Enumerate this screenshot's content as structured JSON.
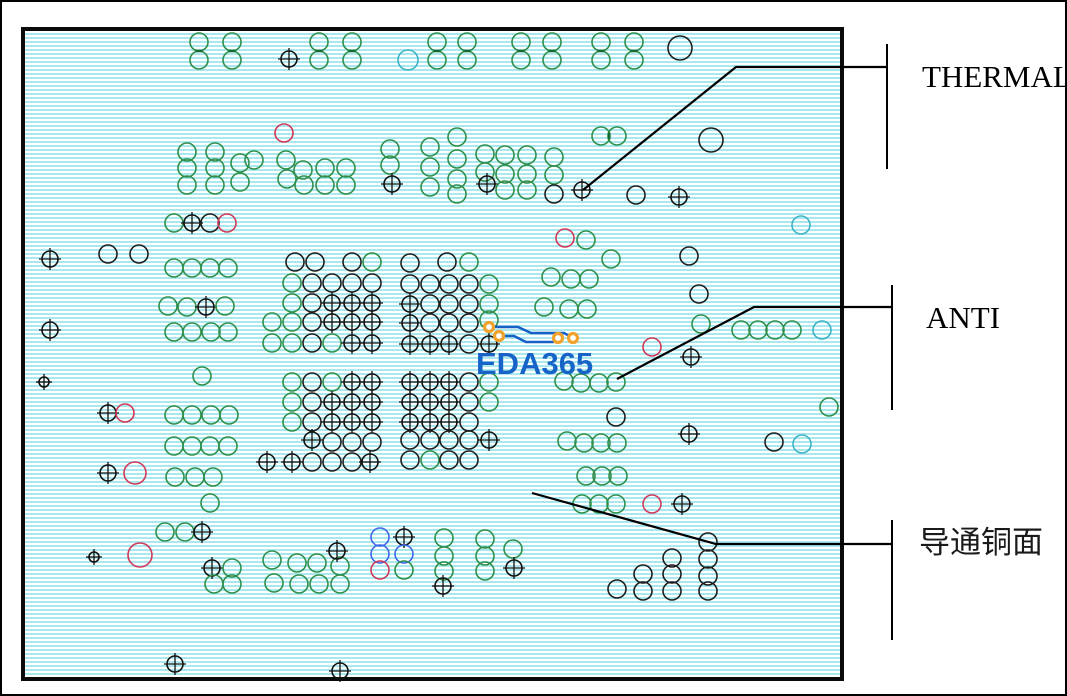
{
  "board": {
    "stripe_color": "#a9e9ed",
    "background": "#ffffff",
    "border_color": "#0a0a0a"
  },
  "watermark": {
    "text": "EDA365",
    "color": "#1764c8"
  },
  "palette": {
    "g": "#2f8f4c",
    "k": "#1f1f1f",
    "r": "#cf3a5a",
    "c": "#3fb3c6",
    "b": "#4169e8",
    "x": "#111111",
    "xs": "#111111",
    "trace": "#1660c6",
    "pad": "#f0a22c",
    "callout": "#000000",
    "dash": "#156b33"
  },
  "callouts": [
    {
      "id": "thermal",
      "label": "THERMAL",
      "points": [
        [
          581,
          188
        ],
        [
          734,
          65
        ],
        [
          885,
          65
        ]
      ],
      "bracket": [
        [
          885,
          42
        ],
        [
          885,
          167
        ]
      ]
    },
    {
      "id": "anti",
      "label": "ANTI",
      "points": [
        [
          615,
          377
        ],
        [
          752,
          305
        ],
        [
          890,
          305
        ]
      ],
      "bracket": [
        [
          890,
          283
        ],
        [
          890,
          408
        ]
      ]
    },
    {
      "id": "copper",
      "label": "导通铜面",
      "points": [
        [
          530,
          491
        ],
        [
          714,
          542
        ],
        [
          890,
          542
        ]
      ],
      "bracket": [
        [
          890,
          518
        ],
        [
          890,
          638
        ]
      ]
    }
  ],
  "traces": [
    [
      [
        487,
        325
      ],
      [
        516,
        325
      ],
      [
        529,
        331
      ],
      [
        562,
        331
      ],
      [
        571,
        336
      ]
    ],
    [
      [
        497,
        334
      ],
      [
        512,
        334
      ],
      [
        524,
        340
      ],
      [
        551,
        340
      ],
      [
        556,
        336
      ]
    ]
  ],
  "trace_pads": [
    [
      487,
      325
    ],
    [
      497,
      334
    ],
    [
      556,
      336
    ],
    [
      571,
      336
    ]
  ],
  "pair_dashes": [
    [
      197,
      49,
      "h"
    ],
    [
      230,
      49,
      "h"
    ],
    [
      317,
      49,
      "h"
    ],
    [
      350,
      49,
      "h"
    ],
    [
      435,
      49,
      "h"
    ],
    [
      465,
      49,
      "h"
    ],
    [
      519,
      49,
      "h"
    ],
    [
      550,
      49,
      "h"
    ],
    [
      599,
      49,
      "h"
    ],
    [
      632,
      49,
      "h"
    ],
    [
      607,
      134,
      "v"
    ]
  ],
  "vias": [
    [
      197,
      40,
      "g"
    ],
    [
      197,
      58,
      "g"
    ],
    [
      230,
      40,
      "g"
    ],
    [
      230,
      58,
      "g"
    ],
    [
      317,
      40,
      "g"
    ],
    [
      317,
      58,
      "g"
    ],
    [
      350,
      40,
      "g"
    ],
    [
      350,
      58,
      "g"
    ],
    [
      435,
      40,
      "g"
    ],
    [
      435,
      58,
      "g"
    ],
    [
      465,
      40,
      "g"
    ],
    [
      465,
      58,
      "g"
    ],
    [
      519,
      40,
      "g"
    ],
    [
      519,
      58,
      "g"
    ],
    [
      550,
      40,
      "g"
    ],
    [
      550,
      58,
      "g"
    ],
    [
      599,
      40,
      "g"
    ],
    [
      599,
      58,
      "g"
    ],
    [
      632,
      40,
      "g"
    ],
    [
      632,
      58,
      "g"
    ],
    [
      287,
      57,
      "x"
    ],
    [
      678,
      46,
      "k",
      12
    ],
    [
      406,
      58,
      "c",
      10
    ],
    [
      282,
      131,
      "r"
    ],
    [
      599,
      134,
      "g"
    ],
    [
      615,
      134,
      "g"
    ],
    [
      709,
      138,
      "k",
      12
    ],
    [
      185,
      150,
      "g"
    ],
    [
      185,
      166,
      "g"
    ],
    [
      185,
      183,
      "g"
    ],
    [
      213,
      150,
      "g"
    ],
    [
      213,
      166,
      "g"
    ],
    [
      213,
      183,
      "g"
    ],
    [
      238,
      161,
      "g"
    ],
    [
      238,
      180,
      "g"
    ],
    [
      252,
      158,
      "g"
    ],
    [
      284,
      158,
      "g"
    ],
    [
      301,
      168,
      "g"
    ],
    [
      285,
      177,
      "g"
    ],
    [
      302,
      183,
      "g"
    ],
    [
      323,
      166,
      "g"
    ],
    [
      323,
      183,
      "g"
    ],
    [
      344,
      166,
      "g"
    ],
    [
      344,
      183,
      "g"
    ],
    [
      388,
      147,
      "g"
    ],
    [
      388,
      163,
      "g"
    ],
    [
      390,
      182,
      "x"
    ],
    [
      428,
      145,
      "g"
    ],
    [
      428,
      165,
      "g"
    ],
    [
      428,
      185,
      "g"
    ],
    [
      455,
      135,
      "g"
    ],
    [
      455,
      157,
      "g"
    ],
    [
      455,
      177,
      "g"
    ],
    [
      455,
      192,
      "g"
    ],
    [
      483,
      152,
      "g"
    ],
    [
      483,
      170,
      "g"
    ],
    [
      485,
      182,
      "x"
    ],
    [
      503,
      153,
      "g"
    ],
    [
      503,
      172,
      "g"
    ],
    [
      503,
      188,
      "g"
    ],
    [
      525,
      153,
      "g"
    ],
    [
      525,
      172,
      "g"
    ],
    [
      525,
      188,
      "g"
    ],
    [
      552,
      155,
      "g"
    ],
    [
      552,
      173,
      "g"
    ],
    [
      552,
      192,
      "k"
    ],
    [
      580,
      188,
      "x"
    ],
    [
      634,
      193,
      "k"
    ],
    [
      677,
      195,
      "x"
    ],
    [
      48,
      257,
      "x"
    ],
    [
      106,
      252,
      "k"
    ],
    [
      137,
      252,
      "k"
    ],
    [
      172,
      266,
      "g"
    ],
    [
      190,
      266,
      "g"
    ],
    [
      208,
      266,
      "g"
    ],
    [
      226,
      266,
      "g"
    ],
    [
      48,
      328,
      "x"
    ],
    [
      166,
      304,
      "g"
    ],
    [
      185,
      305,
      "g"
    ],
    [
      204,
      305,
      "x"
    ],
    [
      223,
      304,
      "g"
    ],
    [
      172,
      330,
      "g"
    ],
    [
      190,
      330,
      "g"
    ],
    [
      209,
      330,
      "g"
    ],
    [
      226,
      330,
      "g"
    ],
    [
      200,
      374,
      "g"
    ],
    [
      42,
      380,
      "xs"
    ],
    [
      106,
      411,
      "x"
    ],
    [
      123,
      411,
      "r"
    ],
    [
      172,
      413,
      "g"
    ],
    [
      190,
      413,
      "g"
    ],
    [
      209,
      413,
      "g"
    ],
    [
      227,
      413,
      "g"
    ],
    [
      172,
      444,
      "g"
    ],
    [
      190,
      444,
      "g"
    ],
    [
      208,
      444,
      "g"
    ],
    [
      226,
      444,
      "g"
    ],
    [
      106,
      471,
      "x"
    ],
    [
      133,
      471,
      "r",
      11
    ],
    [
      173,
      475,
      "g"
    ],
    [
      193,
      475,
      "g"
    ],
    [
      211,
      475,
      "g"
    ],
    [
      208,
      501,
      "g"
    ],
    [
      163,
      530,
      "g"
    ],
    [
      183,
      530,
      "g"
    ],
    [
      200,
      530,
      "x"
    ],
    [
      92,
      555,
      "xs"
    ],
    [
      138,
      553,
      "r",
      12
    ],
    [
      210,
      566,
      "x"
    ],
    [
      230,
      566,
      "g"
    ],
    [
      212,
      582,
      "g"
    ],
    [
      230,
      582,
      "g"
    ],
    [
      172,
      221,
      "g"
    ],
    [
      190,
      221,
      "x"
    ],
    [
      208,
      221,
      "k"
    ],
    [
      225,
      221,
      "r"
    ],
    [
      173,
      662,
      "x"
    ],
    [
      338,
      669,
      "x"
    ],
    [
      293,
      260,
      "k"
    ],
    [
      313,
      260,
      "k"
    ],
    [
      350,
      260,
      "k"
    ],
    [
      370,
      260,
      "g"
    ],
    [
      408,
      261,
      "k"
    ],
    [
      445,
      260,
      "k"
    ],
    [
      467,
      260,
      "g"
    ],
    [
      290,
      281,
      "g"
    ],
    [
      310,
      281,
      "k"
    ],
    [
      330,
      281,
      "k"
    ],
    [
      350,
      281,
      "k"
    ],
    [
      370,
      281,
      "k"
    ],
    [
      408,
      282,
      "k"
    ],
    [
      428,
      282,
      "k"
    ],
    [
      447,
      282,
      "k"
    ],
    [
      467,
      282,
      "k"
    ],
    [
      487,
      282,
      "g"
    ],
    [
      290,
      301,
      "g"
    ],
    [
      310,
      301,
      "k"
    ],
    [
      330,
      301,
      "x"
    ],
    [
      350,
      301,
      "x"
    ],
    [
      370,
      301,
      "x"
    ],
    [
      408,
      302,
      "x"
    ],
    [
      428,
      302,
      "k"
    ],
    [
      447,
      302,
      "k"
    ],
    [
      467,
      302,
      "k"
    ],
    [
      487,
      302,
      "g"
    ],
    [
      270,
      320,
      "g"
    ],
    [
      290,
      320,
      "g"
    ],
    [
      310,
      320,
      "k"
    ],
    [
      330,
      320,
      "x"
    ],
    [
      350,
      320,
      "x"
    ],
    [
      370,
      320,
      "x"
    ],
    [
      408,
      321,
      "x"
    ],
    [
      428,
      321,
      "k"
    ],
    [
      447,
      321,
      "k"
    ],
    [
      467,
      321,
      "k"
    ],
    [
      487,
      318,
      "g"
    ],
    [
      270,
      341,
      "g"
    ],
    [
      290,
      341,
      "g"
    ],
    [
      310,
      341,
      "k"
    ],
    [
      330,
      341,
      "g"
    ],
    [
      350,
      341,
      "x"
    ],
    [
      370,
      341,
      "x"
    ],
    [
      408,
      342,
      "x"
    ],
    [
      428,
      342,
      "x"
    ],
    [
      447,
      342,
      "x"
    ],
    [
      467,
      342,
      "k"
    ],
    [
      487,
      342,
      "x"
    ],
    [
      290,
      380,
      "g"
    ],
    [
      310,
      380,
      "k"
    ],
    [
      330,
      380,
      "g"
    ],
    [
      350,
      380,
      "x"
    ],
    [
      370,
      380,
      "x"
    ],
    [
      408,
      380,
      "x"
    ],
    [
      428,
      380,
      "x"
    ],
    [
      447,
      380,
      "x"
    ],
    [
      467,
      380,
      "k"
    ],
    [
      487,
      380,
      "g"
    ],
    [
      290,
      400,
      "g"
    ],
    [
      310,
      400,
      "k"
    ],
    [
      330,
      400,
      "x"
    ],
    [
      350,
      400,
      "x"
    ],
    [
      370,
      400,
      "x"
    ],
    [
      408,
      400,
      "x"
    ],
    [
      428,
      400,
      "x"
    ],
    [
      447,
      400,
      "x"
    ],
    [
      467,
      400,
      "k"
    ],
    [
      487,
      400,
      "g"
    ],
    [
      290,
      420,
      "g"
    ],
    [
      310,
      420,
      "k"
    ],
    [
      330,
      420,
      "x"
    ],
    [
      350,
      420,
      "x"
    ],
    [
      370,
      420,
      "x"
    ],
    [
      408,
      420,
      "x"
    ],
    [
      428,
      420,
      "x"
    ],
    [
      447,
      420,
      "x"
    ],
    [
      467,
      420,
      "k"
    ],
    [
      310,
      438,
      "x"
    ],
    [
      330,
      440,
      "k"
    ],
    [
      350,
      440,
      "k"
    ],
    [
      370,
      440,
      "k"
    ],
    [
      408,
      438,
      "k"
    ],
    [
      428,
      438,
      "k"
    ],
    [
      447,
      438,
      "k"
    ],
    [
      467,
      438,
      "k"
    ],
    [
      487,
      438,
      "x"
    ],
    [
      265,
      460,
      "x"
    ],
    [
      290,
      460,
      "x"
    ],
    [
      310,
      460,
      "k"
    ],
    [
      330,
      460,
      "k"
    ],
    [
      350,
      460,
      "k"
    ],
    [
      368,
      460,
      "x"
    ],
    [
      408,
      458,
      "k"
    ],
    [
      428,
      458,
      "g"
    ],
    [
      447,
      458,
      "k"
    ],
    [
      467,
      458,
      "k"
    ],
    [
      563,
      236,
      "r"
    ],
    [
      584,
      238,
      "g"
    ],
    [
      609,
      257,
      "g"
    ],
    [
      549,
      275,
      "g"
    ],
    [
      569,
      277,
      "g"
    ],
    [
      587,
      277,
      "g"
    ],
    [
      542,
      305,
      "g"
    ],
    [
      567,
      307,
      "g"
    ],
    [
      585,
      307,
      "g"
    ],
    [
      687,
      254,
      "k"
    ],
    [
      697,
      292,
      "k"
    ],
    [
      699,
      322,
      "g"
    ],
    [
      650,
      345,
      "r"
    ],
    [
      689,
      355,
      "x"
    ],
    [
      739,
      328,
      "g"
    ],
    [
      756,
      328,
      "g"
    ],
    [
      773,
      328,
      "g"
    ],
    [
      790,
      328,
      "g"
    ],
    [
      820,
      328,
      "c"
    ],
    [
      799,
      223,
      "c"
    ],
    [
      562,
      379,
      "g"
    ],
    [
      579,
      381,
      "g"
    ],
    [
      597,
      381,
      "g"
    ],
    [
      614,
      380,
      "g"
    ],
    [
      827,
      405,
      "g"
    ],
    [
      614,
      415,
      "k"
    ],
    [
      565,
      439,
      "g"
    ],
    [
      582,
      441,
      "g"
    ],
    [
      599,
      441,
      "g"
    ],
    [
      615,
      441,
      "g"
    ],
    [
      687,
      432,
      "x"
    ],
    [
      772,
      440,
      "k"
    ],
    [
      800,
      442,
      "c"
    ],
    [
      442,
      536,
      "g"
    ],
    [
      442,
      554,
      "g"
    ],
    [
      442,
      569,
      "g"
    ],
    [
      441,
      584,
      "x"
    ],
    [
      483,
      537,
      "g"
    ],
    [
      483,
      554,
      "g"
    ],
    [
      483,
      569,
      "g"
    ],
    [
      511,
      547,
      "g"
    ],
    [
      512,
      566,
      "x"
    ],
    [
      270,
      558,
      "g"
    ],
    [
      295,
      561,
      "g"
    ],
    [
      315,
      561,
      "g"
    ],
    [
      338,
      564,
      "g"
    ],
    [
      272,
      581,
      "g"
    ],
    [
      297,
      582,
      "g"
    ],
    [
      317,
      582,
      "g"
    ],
    [
      338,
      582,
      "g"
    ],
    [
      335,
      549,
      "x"
    ],
    [
      378,
      535,
      "b"
    ],
    [
      402,
      535,
      "x"
    ],
    [
      378,
      552,
      "b"
    ],
    [
      402,
      552,
      "b"
    ],
    [
      378,
      568,
      "r"
    ],
    [
      402,
      568,
      "g"
    ],
    [
      584,
      474,
      "g"
    ],
    [
      600,
      474,
      "g"
    ],
    [
      616,
      474,
      "g"
    ],
    [
      580,
      502,
      "g"
    ],
    [
      597,
      502,
      "g"
    ],
    [
      614,
      502,
      "g"
    ],
    [
      650,
      502,
      "r"
    ],
    [
      680,
      502,
      "x"
    ],
    [
      615,
      587,
      "k"
    ],
    [
      641,
      572,
      "k"
    ],
    [
      641,
      589,
      "k"
    ],
    [
      670,
      556,
      "k"
    ],
    [
      670,
      572,
      "k"
    ],
    [
      670,
      589,
      "k"
    ],
    [
      706,
      540,
      "k"
    ],
    [
      706,
      557,
      "k"
    ],
    [
      706,
      574,
      "k"
    ],
    [
      706,
      589,
      "k"
    ]
  ]
}
